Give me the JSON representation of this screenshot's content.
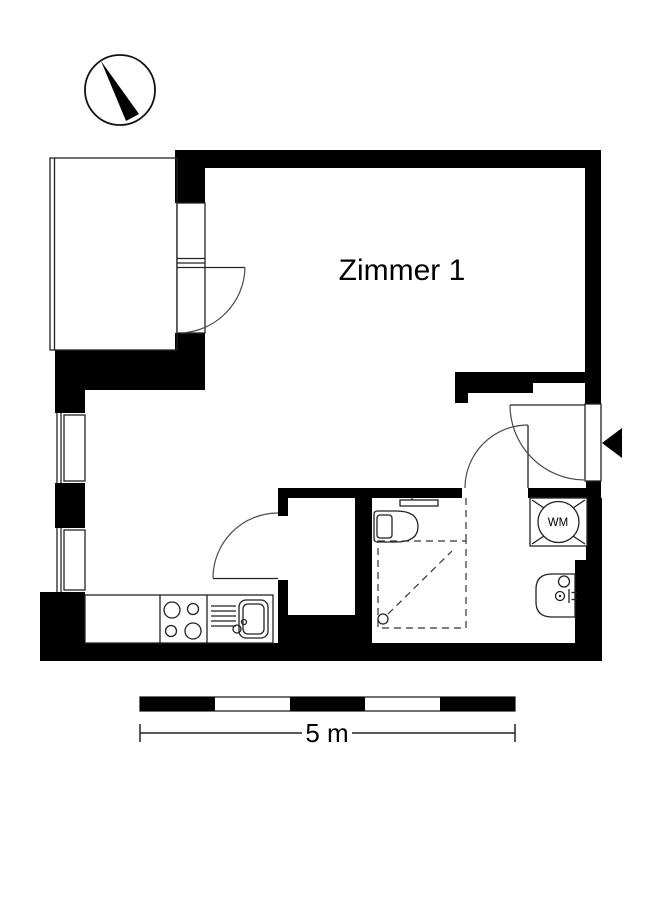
{
  "labels": {
    "room1": "Zimmer 1",
    "washing_machine": "WM",
    "scale": "5 m"
  },
  "colors": {
    "wall": "#000000",
    "background": "#ffffff",
    "thin_line": "#222222",
    "arc": "#4a4a4a"
  },
  "icons": {
    "compass": "north-compass",
    "entrance_marker": "entrance-arrow"
  }
}
